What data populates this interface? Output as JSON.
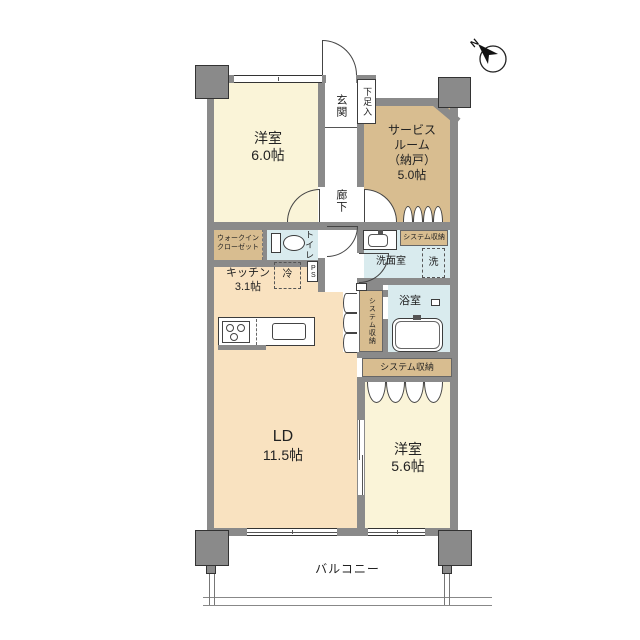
{
  "plan_title": "マンション間取り図",
  "compass": {
    "label": "N"
  },
  "rooms": {
    "bedroom1": {
      "name": "洋室",
      "size": "6.0帖"
    },
    "service_room": {
      "name_line1": "サービス",
      "name_line2": "ルーム",
      "name_line3": "（納戸）",
      "size": "5.0帖"
    },
    "entrance": {
      "label": "玄関"
    },
    "shoe_cabinet": {
      "label": "下足入"
    },
    "corridor": {
      "label": "廊下"
    },
    "walk_in_closet": {
      "label_line1": "ウォークイン",
      "label_line2": "クローゼット"
    },
    "toilet": {
      "label": "トイレ"
    },
    "refrigerator": {
      "label": "冷"
    },
    "kitchen": {
      "name": "キッチン",
      "size": "3.1帖"
    },
    "pipe_space": {
      "label": "PS"
    },
    "washroom": {
      "label": "洗面室"
    },
    "washer": {
      "label": "洗"
    },
    "storage_washroom": {
      "label": "システム収納"
    },
    "storage_bathside": {
      "label": "システム収納"
    },
    "storage_bedroom2": {
      "label": "システム収納"
    },
    "bathroom": {
      "label": "浴室"
    },
    "living_dining": {
      "name": "LD",
      "size": "11.5帖"
    },
    "bedroom2": {
      "name": "洋室",
      "size": "5.6帖"
    },
    "balcony": {
      "label": "バルコニー"
    }
  },
  "colors": {
    "wall": "#8a8a8a",
    "bedroom_fill": "#faf4d8",
    "storage_fill": "#d8bd90",
    "living_fill": "#f9e2c0",
    "wet_fill": "#d9ebee",
    "line": "#3c3c3c"
  }
}
